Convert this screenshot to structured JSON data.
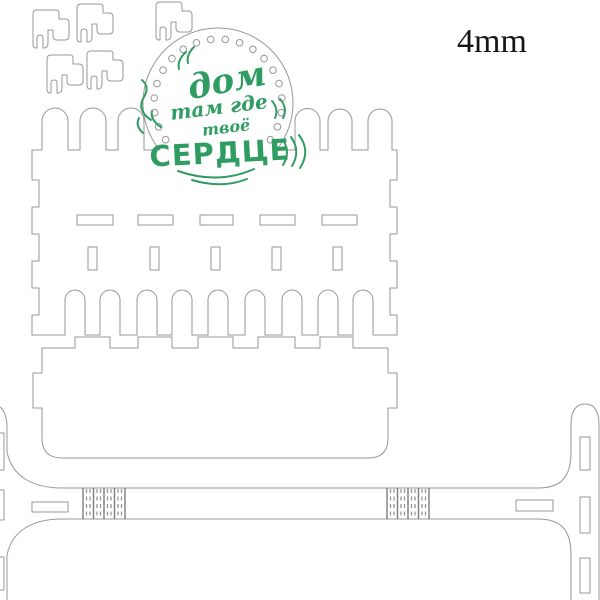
{
  "material_label": {
    "text": "4mm"
  },
  "badge": {
    "word1": "дом",
    "word2": "там где",
    "word3": "твоё",
    "word4": "СЕРДЦЕ"
  },
  "colors": {
    "background": "#ffffff",
    "cut_outline": "#979797",
    "engraving_green": "#2f9d62",
    "label_text": "#161616"
  },
  "icons": {
    "badge_dot_ring": "circle-dots",
    "living_hinge": "dashed-flex-lines"
  }
}
